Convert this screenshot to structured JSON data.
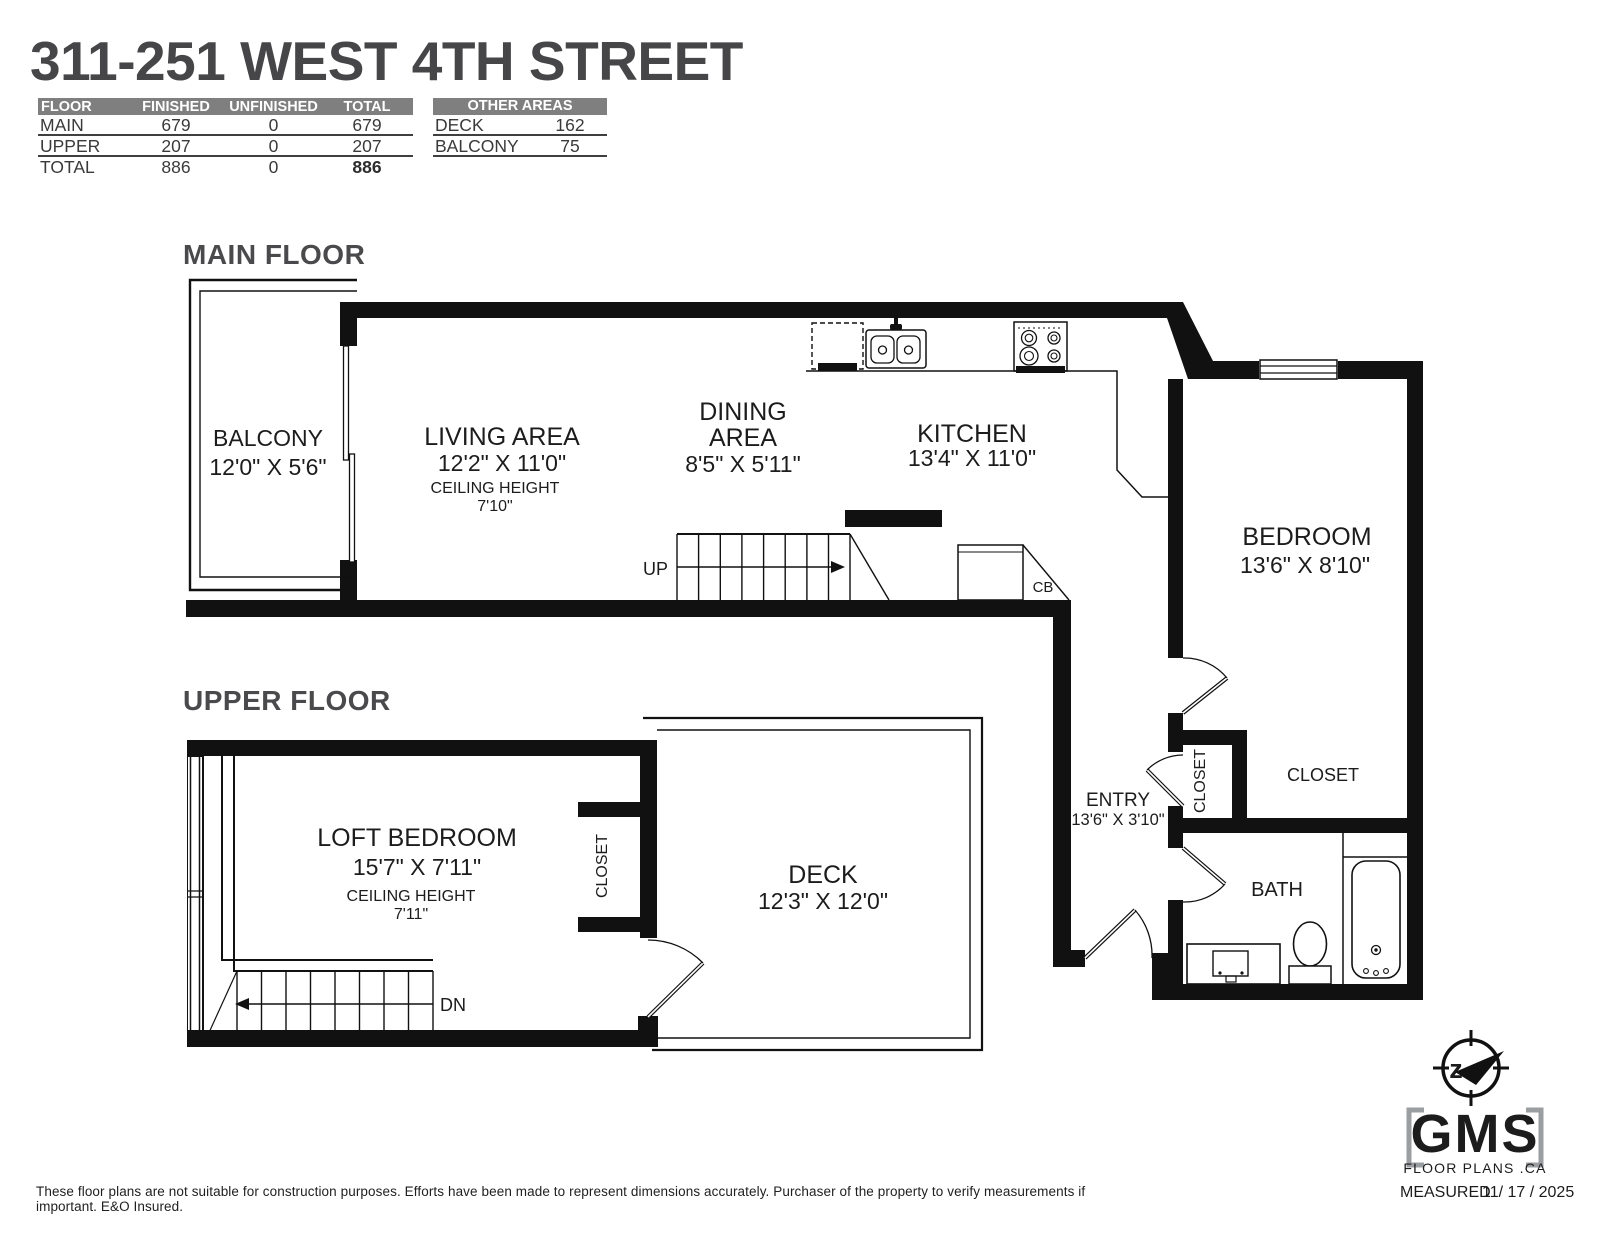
{
  "title": "311-251 WEST 4TH STREET",
  "floor_table": {
    "headers": [
      "FLOOR",
      "FINISHED",
      "UNFINISHED",
      "TOTAL"
    ],
    "rows": [
      {
        "floor": "MAIN",
        "finished": "679",
        "unfinished": "0",
        "total": "679"
      },
      {
        "floor": "UPPER",
        "finished": "207",
        "unfinished": "0",
        "total": "207"
      },
      {
        "floor": "TOTAL",
        "finished": "886",
        "unfinished": "0",
        "total": "886"
      }
    ]
  },
  "other_areas_table": {
    "header": "OTHER AREAS",
    "rows": [
      {
        "area": "DECK",
        "value": "162"
      },
      {
        "area": "BALCONY",
        "value": "75"
      }
    ]
  },
  "floors": {
    "main": "MAIN FLOOR",
    "upper": "UPPER FLOOR"
  },
  "rooms": {
    "balcony": {
      "name": "BALCONY",
      "dims": "12'0\" X 5'6\""
    },
    "living_area": {
      "name": "LIVING AREA",
      "dims": "12'2\" X 11'0\"",
      "ceiling_label": "CEILING HEIGHT",
      "ceiling_value": "7'10\""
    },
    "dining_area": {
      "name_line1": "DINING",
      "name_line2": "AREA",
      "dims": "8'5\" X 5'11\""
    },
    "kitchen": {
      "name": "KITCHEN",
      "dims": "13'4\" X 11'0\""
    },
    "bedroom": {
      "name": "BEDROOM",
      "dims": "13'6\" X 8'10\""
    },
    "entry": {
      "name": "ENTRY",
      "dims": "13'6\" X 3'10\""
    },
    "bath": {
      "name": "BATH"
    },
    "closet_entry": {
      "name": "CLOSET"
    },
    "closet_bedroom": {
      "name": "CLOSET"
    },
    "loft_bedroom": {
      "name": "LOFT BEDROOM",
      "dims": "15'7\" X 7'11\"",
      "ceiling_label": "CEILING HEIGHT",
      "ceiling_value": "7'11\""
    },
    "closet_upper": {
      "name": "CLOSET"
    },
    "deck": {
      "name": "DECK",
      "dims": "12'3\" X 12'0\""
    }
  },
  "stairs": {
    "up": "UP",
    "down": "DN"
  },
  "labels": {
    "cb": "CB"
  },
  "logo": {
    "compass_letter": "z",
    "brand": "GMS",
    "brand_sub": "FLOOR PLANS .CA",
    "measured_label": "MEASURED",
    "measured_date": "11/ 17 / 2025"
  },
  "footer": {
    "disclaimer": "These floor plans are not suitable for construction purposes. Efforts have been made to represent dimensions accurately.  Purchaser of the property to verify measurements if important.  E&O Insured."
  },
  "colors": {
    "wall": "#111111",
    "heading": "#4a4a4c",
    "table_bar": "#7f7f80",
    "logo_navy": "#2c3e6b",
    "logo_gray": "#9a9ea1"
  }
}
